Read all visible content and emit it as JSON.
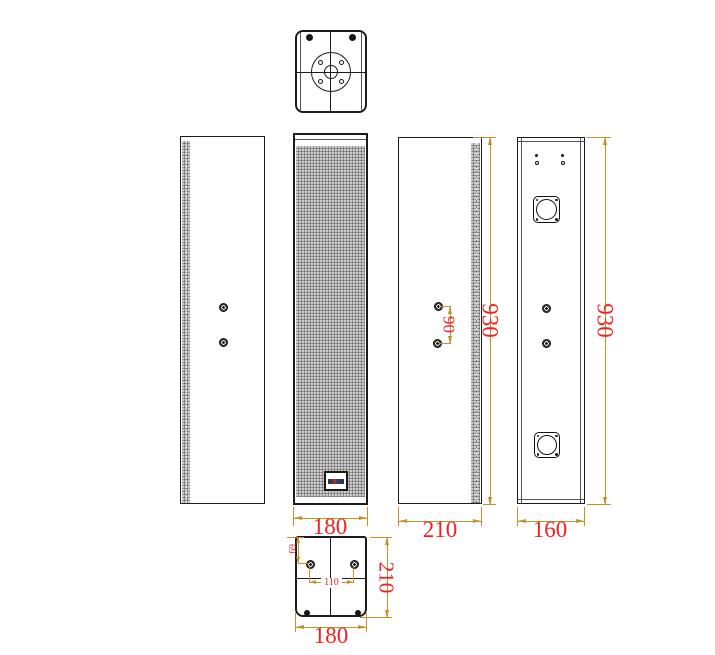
{
  "dimensions": {
    "front_width": "180",
    "front_height": "930",
    "side_depth": "210",
    "rear_width": "160",
    "rear_height": "930",
    "side_screw_spacing": "90",
    "bottom_width": "180",
    "bottom_depth": "210",
    "bottom_insert_spacing": "110",
    "bottom_insert_offset": "69"
  },
  "colors": {
    "dimension_line": "#C4912A",
    "dimension_text": "#F42020",
    "outline": "#1C1C1C",
    "grille_fill": "#9C9C9C"
  }
}
